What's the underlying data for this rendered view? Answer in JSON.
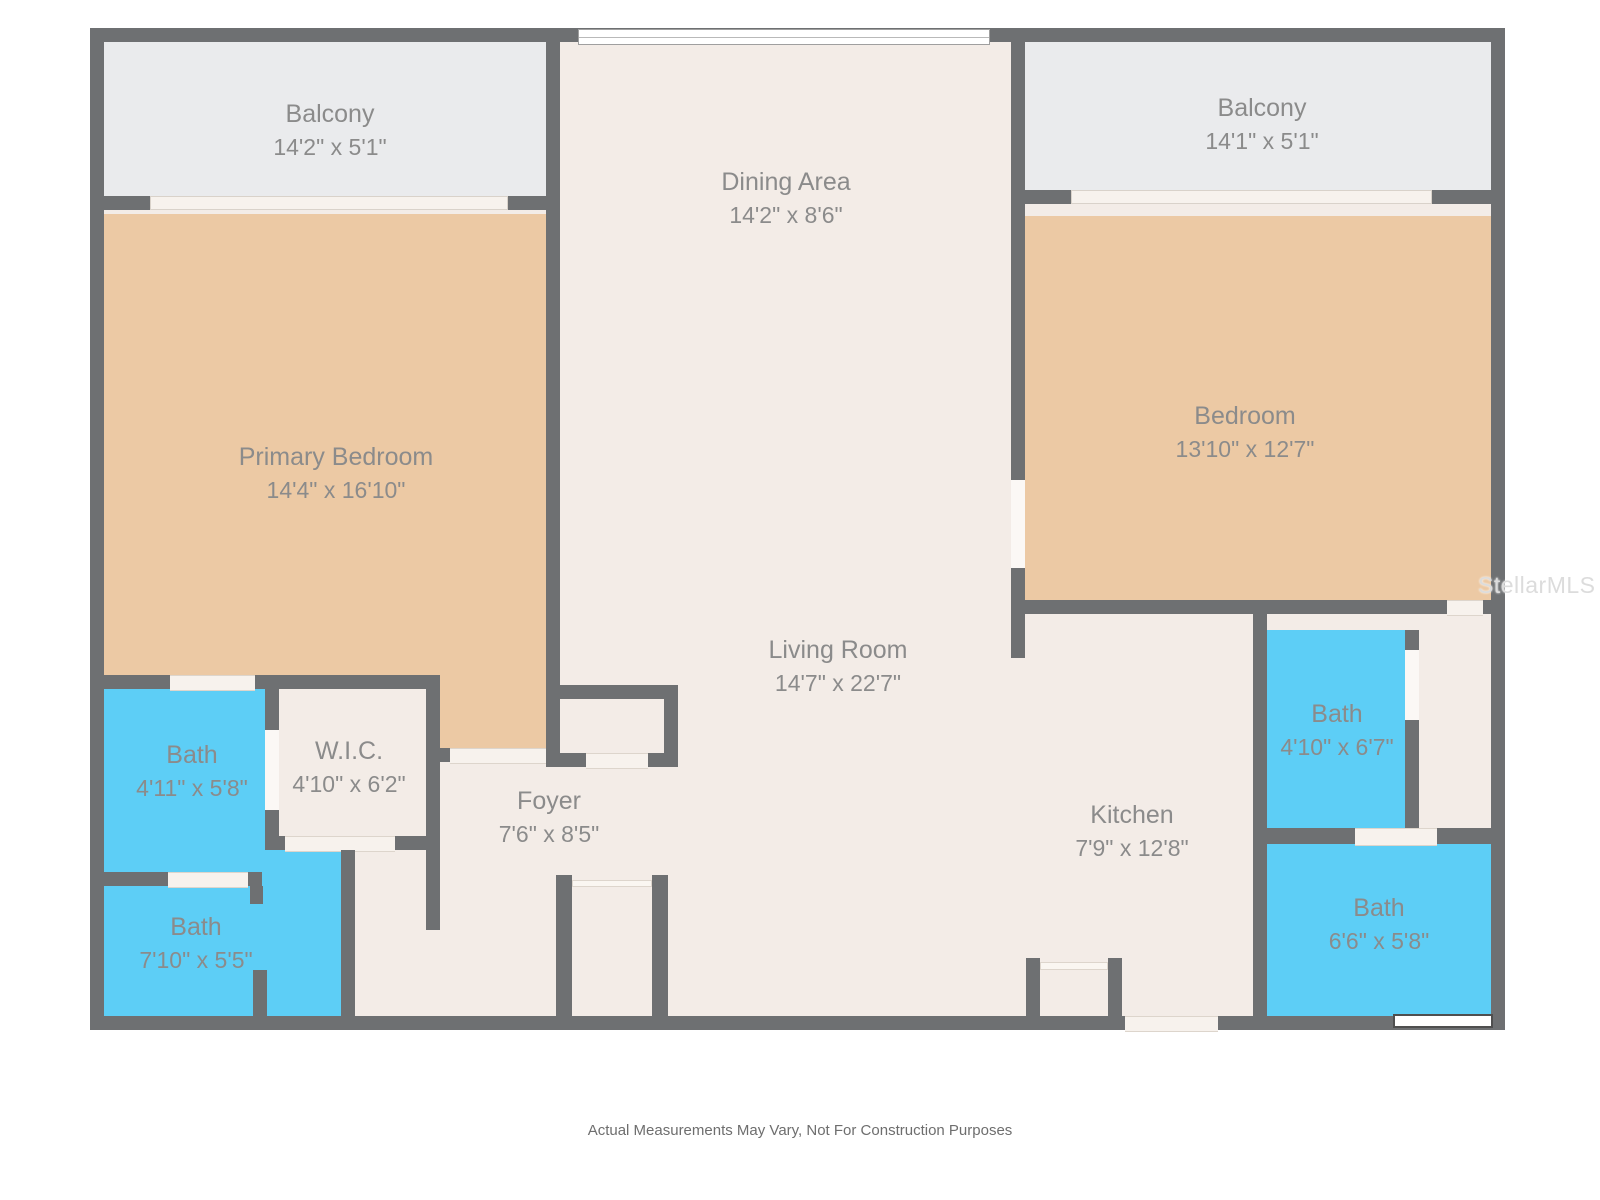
{
  "watermark": "StellarMLS",
  "footer": "Actual Measurements May Vary, Not For Construction Purposes",
  "colors": {
    "wall": "#6e7072",
    "floor": "#f3ece7",
    "tan": "#ecc9a4",
    "cyan": "#5dcef6",
    "balcony": "#eaebed",
    "gap": "#f7f2ed",
    "vgap": "#fbf8f5",
    "label": "#8b8b8b"
  },
  "rooms": [
    {
      "name": "Balcony",
      "dims": "14'2\" x 5'1\""
    },
    {
      "name": "Dining Area",
      "dims": "14'2\" x 8'6\""
    },
    {
      "name": "Balcony",
      "dims": "14'1\" x 5'1\""
    },
    {
      "name": "Primary Bedroom",
      "dims": "14'4\" x 16'10\""
    },
    {
      "name": "Bedroom",
      "dims": "13'10\" x 12'7\""
    },
    {
      "name": "Living Room",
      "dims": "14'7\" x 22'7\""
    },
    {
      "name": "Bath",
      "dims": "4'11\" x 5'8\""
    },
    {
      "name": "W.I.C.",
      "dims": "4'10\" x 6'2\""
    },
    {
      "name": "Foyer",
      "dims": "7'6\" x 8'5\""
    },
    {
      "name": "Bath",
      "dims": "7'10\" x 5'5\""
    },
    {
      "name": "Kitchen",
      "dims": "7'9\" x 12'8\""
    },
    {
      "name": "Bath",
      "dims": "4'10\" x 6'7\""
    },
    {
      "name": "Bath",
      "dims": "6'6\" x 5'8\""
    }
  ]
}
